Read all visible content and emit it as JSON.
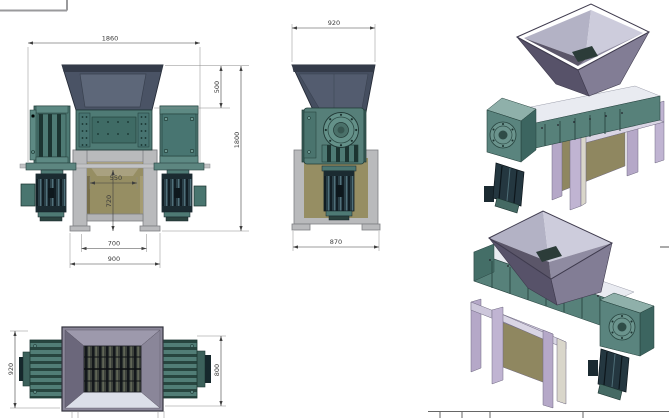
{
  "drawing": {
    "type": "cad-multiview-shredder",
    "dims": {
      "front_overall_width": "1860",
      "front_hopper_height": "500",
      "front_total_height": "1800",
      "front_chamber_width": "550",
      "front_discharge_height": "720",
      "front_base_inner_width": "700",
      "front_base_width": "900",
      "side_hopper_width": "920",
      "side_base_width": "870",
      "top_length": "920",
      "top_width": "800"
    }
  },
  "palette": {
    "hopper_slate": "#4a5365",
    "hopper_rim": "#343b49",
    "machine_teal": "#4e7a74",
    "teal_dark": "#1c3431",
    "stand_gray": "#b9babc",
    "cabinet_olive": "#968e63",
    "iso_box_purple": "#8b8799",
    "iso_leg_lavender": "#b5a8c8",
    "motor_dark": "#2a3f47",
    "dimension_line": "#3f3f3f"
  }
}
